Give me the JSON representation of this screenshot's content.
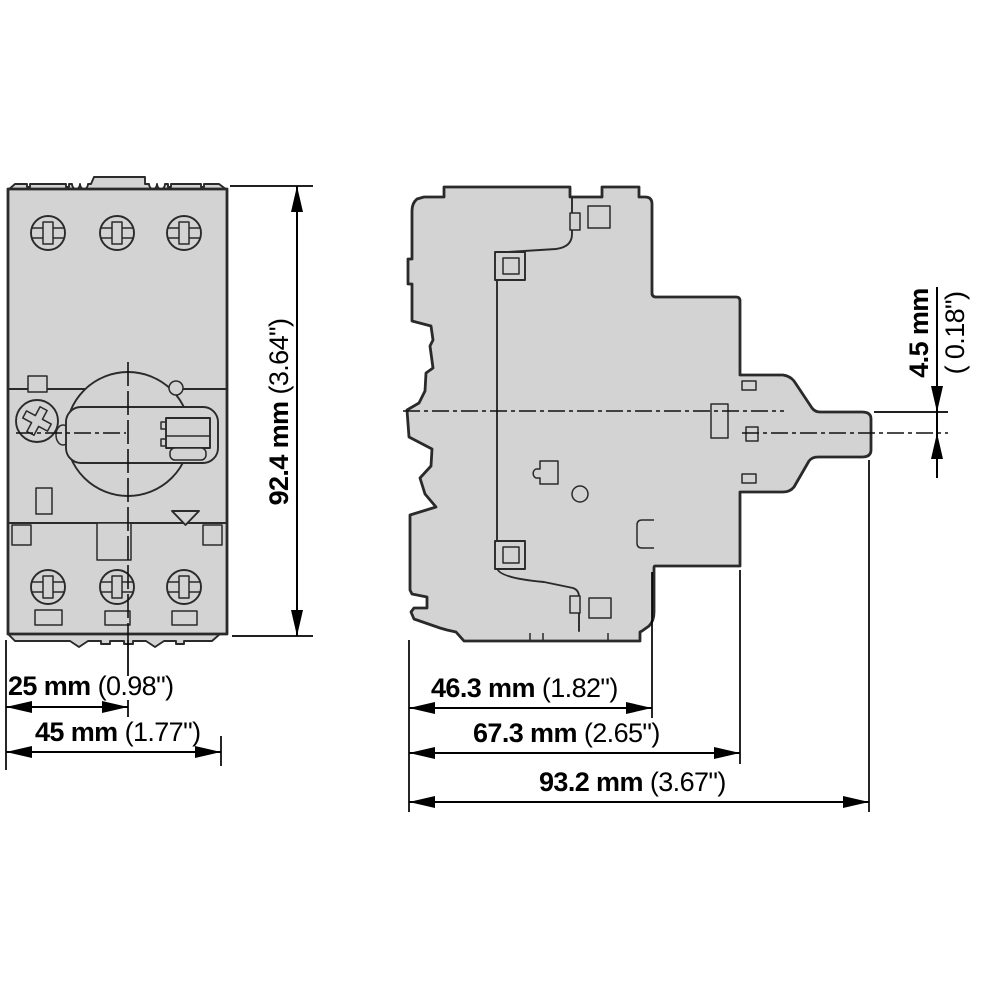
{
  "drawing": {
    "description": "Dimension drawing of a motor-protective circuit breaker, front view and side view",
    "colors": {
      "background": "#ffffff",
      "body_fill": "#d3d3d3",
      "outline": "#2a2a2a",
      "dimension": "#000000"
    },
    "dims": {
      "height": {
        "mm": "92.4 mm",
        "inch": "(3.64\")"
      },
      "pole_width": {
        "mm": "25 mm",
        "inch": "(0.98\")"
      },
      "total_width": {
        "mm": "45 mm",
        "inch": "(1.77\")"
      },
      "body_depth": {
        "mm": "46.3 mm",
        "inch": "(1.82\")"
      },
      "depth_to_knob": {
        "mm": "67.3 mm",
        "inch": "(2.65\")"
      },
      "total_depth": {
        "mm": "93.2 mm",
        "inch": "(3.67\")"
      },
      "knob_offset": {
        "mm": "4.5 mm",
        "inch": "( 0.18\")"
      }
    }
  }
}
